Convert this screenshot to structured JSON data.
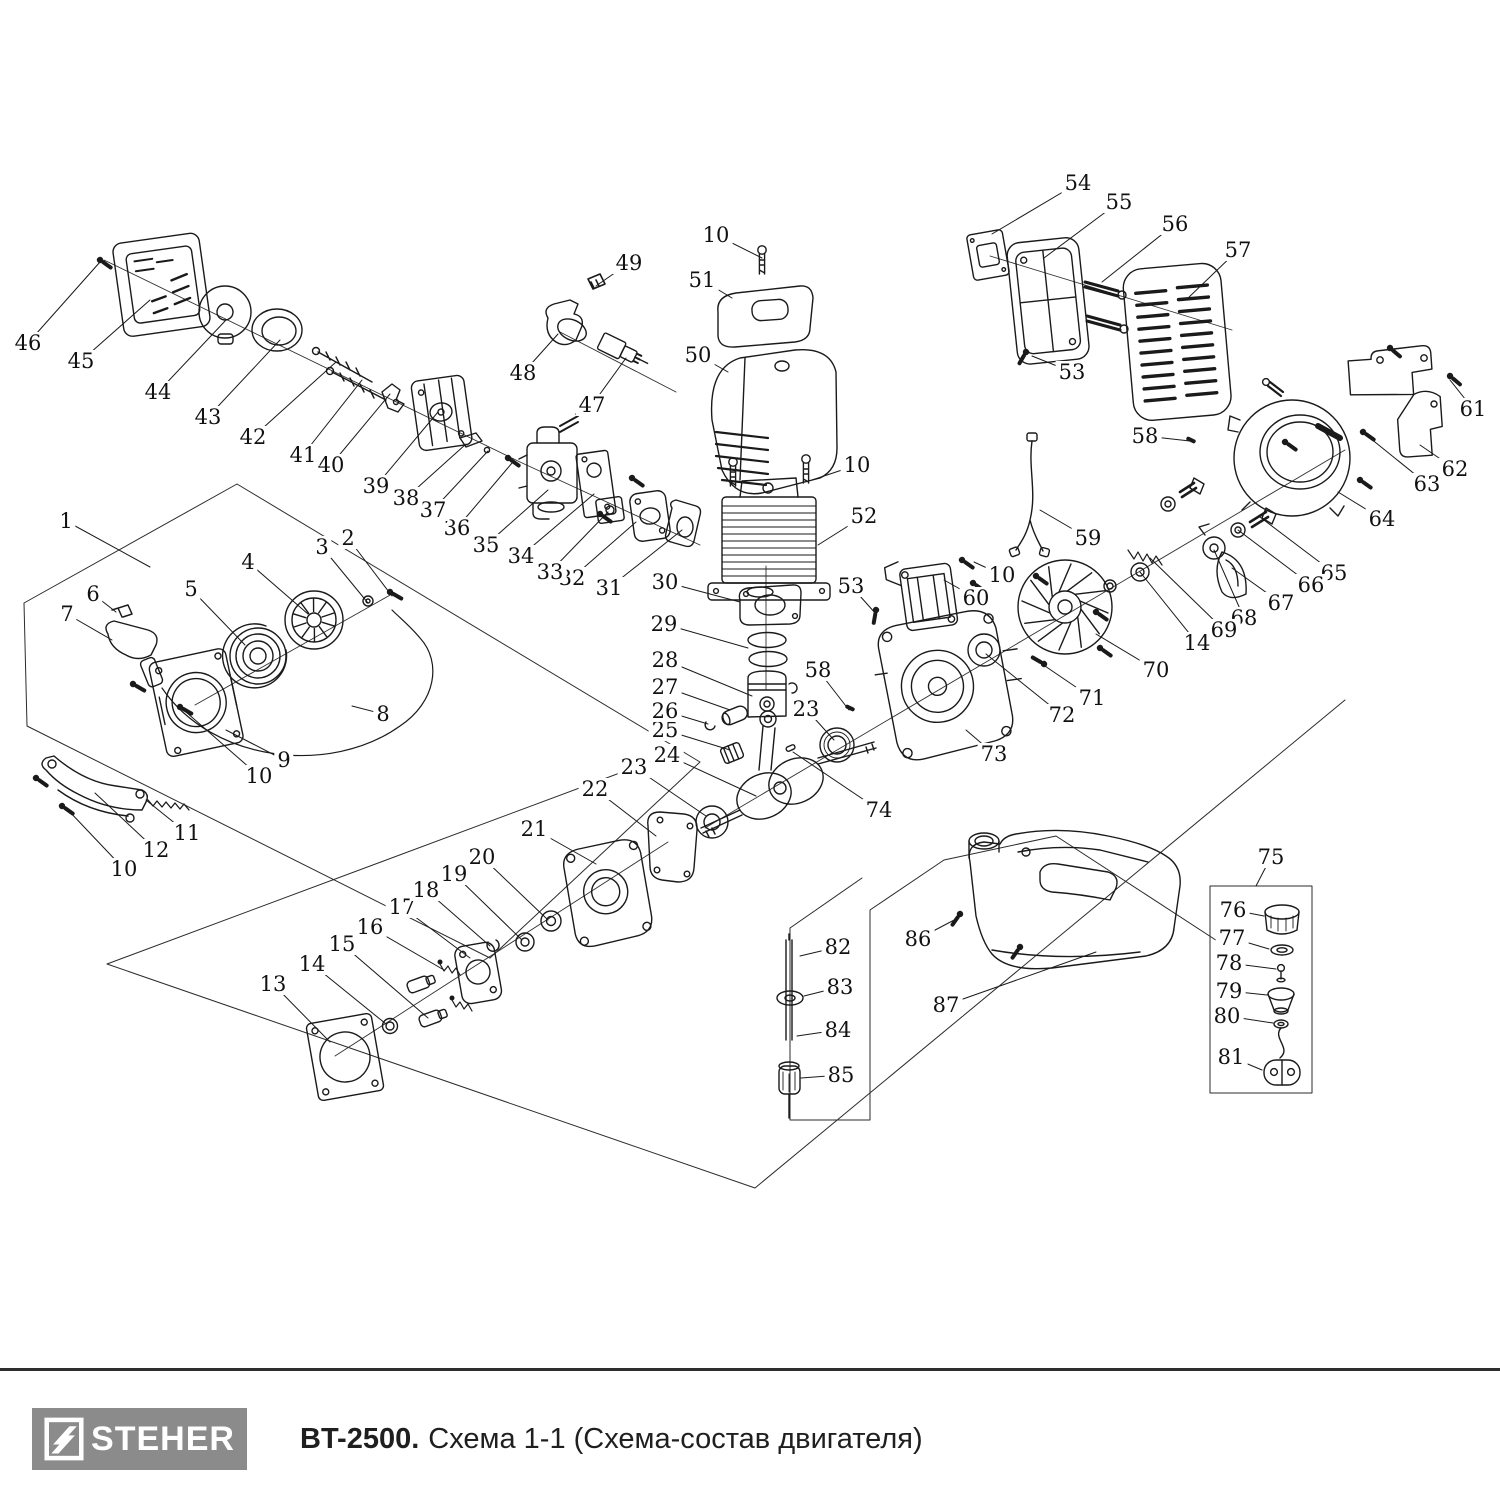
{
  "page": {
    "background": "#ffffff",
    "line_color": "#1a1a1a"
  },
  "footer": {
    "brand": "STEHER",
    "brand_bg": "#8b8b8b",
    "title_bold": "BT-2500.",
    "title_rest": "Схема 1-1 (Схема-состав двигателя)"
  },
  "diagram": {
    "kind": "exploded-parts-diagram",
    "callouts": [
      {
        "n": "1",
        "x": 66,
        "y": 521,
        "tx": 150,
        "ty": 567
      },
      {
        "n": "2",
        "x": 348,
        "y": 538,
        "tx": 392,
        "ty": 596
      },
      {
        "n": "3",
        "x": 322,
        "y": 547,
        "tx": 368,
        "ty": 603
      },
      {
        "n": "4",
        "x": 248,
        "y": 562,
        "tx": 308,
        "ty": 614
      },
      {
        "n": "5",
        "x": 191,
        "y": 589,
        "tx": 245,
        "ty": 645
      },
      {
        "n": "6",
        "x": 93,
        "y": 594,
        "tx": 116,
        "ty": 612
      },
      {
        "n": "7",
        "x": 67,
        "y": 614,
        "tx": 112,
        "ty": 640
      },
      {
        "n": "8",
        "x": 383,
        "y": 714,
        "tx": 352,
        "ty": 706
      },
      {
        "n": "9",
        "x": 284,
        "y": 760,
        "tx": 226,
        "ty": 730
      },
      {
        "n": "10",
        "x": 716,
        "y": 235,
        "tx": 762,
        "ty": 258
      },
      {
        "n": "10",
        "x": 857,
        "y": 465,
        "tx": 812,
        "ty": 480
      },
      {
        "n": "10",
        "x": 1002,
        "y": 575,
        "tx": 974,
        "ty": 562
      },
      {
        "n": "10",
        "x": 259,
        "y": 776,
        "tx": 186,
        "ty": 712
      },
      {
        "n": "10",
        "x": 124,
        "y": 869,
        "tx": 68,
        "ty": 810
      },
      {
        "n": "11",
        "x": 187,
        "y": 833,
        "tx": 146,
        "ty": 800
      },
      {
        "n": "12",
        "x": 156,
        "y": 850,
        "tx": 95,
        "ty": 793
      },
      {
        "n": "13",
        "x": 273,
        "y": 984,
        "tx": 330,
        "ty": 1042
      },
      {
        "n": "14",
        "x": 312,
        "y": 964,
        "tx": 386,
        "ty": 1024
      },
      {
        "n": "14",
        "x": 1197,
        "y": 643,
        "tx": 1140,
        "ty": 572
      },
      {
        "n": "15",
        "x": 342,
        "y": 944,
        "tx": 428,
        "ty": 1018
      },
      {
        "n": "16",
        "x": 370,
        "y": 927,
        "tx": 444,
        "ty": 970
      },
      {
        "n": "17",
        "x": 402,
        "y": 907,
        "tx": 470,
        "ty": 958
      },
      {
        "n": "18",
        "x": 426,
        "y": 890,
        "tx": 490,
        "ty": 946
      },
      {
        "n": "19",
        "x": 454,
        "y": 874,
        "tx": 522,
        "ty": 940
      },
      {
        "n": "20",
        "x": 482,
        "y": 857,
        "tx": 548,
        "ty": 920
      },
      {
        "n": "21",
        "x": 534,
        "y": 829,
        "tx": 596,
        "ty": 864
      },
      {
        "n": "22",
        "x": 595,
        "y": 789,
        "tx": 656,
        "ty": 836
      },
      {
        "n": "23",
        "x": 634,
        "y": 767,
        "tx": 706,
        "ty": 816
      },
      {
        "n": "23",
        "x": 806,
        "y": 709,
        "tx": 834,
        "ty": 740
      },
      {
        "n": "24",
        "x": 667,
        "y": 755,
        "tx": 756,
        "ty": 796
      },
      {
        "n": "25",
        "x": 665,
        "y": 730,
        "tx": 730,
        "ty": 750
      },
      {
        "n": "26",
        "x": 665,
        "y": 711,
        "tx": 708,
        "ty": 724
      },
      {
        "n": "27",
        "x": 665,
        "y": 687,
        "tx": 730,
        "ty": 710
      },
      {
        "n": "28",
        "x": 665,
        "y": 660,
        "tx": 752,
        "ty": 696
      },
      {
        "n": "29",
        "x": 664,
        "y": 624,
        "tx": 748,
        "ty": 648
      },
      {
        "n": "30",
        "x": 665,
        "y": 582,
        "tx": 740,
        "ty": 602
      },
      {
        "n": "31",
        "x": 609,
        "y": 588,
        "tx": 682,
        "ty": 530
      },
      {
        "n": "32",
        "x": 572,
        "y": 578,
        "tx": 636,
        "ty": 522
      },
      {
        "n": "33",
        "x": 550,
        "y": 572,
        "tx": 608,
        "ty": 512
      },
      {
        "n": "34",
        "x": 521,
        "y": 556,
        "tx": 594,
        "ty": 494
      },
      {
        "n": "35",
        "x": 486,
        "y": 545,
        "tx": 548,
        "ty": 490
      },
      {
        "n": "36",
        "x": 457,
        "y": 528,
        "tx": 512,
        "ty": 463
      },
      {
        "n": "37",
        "x": 433,
        "y": 510,
        "tx": 488,
        "ty": 451
      },
      {
        "n": "38",
        "x": 406,
        "y": 498,
        "tx": 466,
        "ty": 444
      },
      {
        "n": "39",
        "x": 376,
        "y": 486,
        "tx": 438,
        "ty": 412
      },
      {
        "n": "40",
        "x": 331,
        "y": 465,
        "tx": 390,
        "ty": 394
      },
      {
        "n": "41",
        "x": 303,
        "y": 455,
        "tx": 362,
        "ty": 380
      },
      {
        "n": "42",
        "x": 253,
        "y": 437,
        "tx": 336,
        "ty": 362
      },
      {
        "n": "43",
        "x": 208,
        "y": 417,
        "tx": 280,
        "ty": 340
      },
      {
        "n": "44",
        "x": 158,
        "y": 392,
        "tx": 226,
        "ty": 320
      },
      {
        "n": "45",
        "x": 81,
        "y": 361,
        "tx": 150,
        "ty": 300
      },
      {
        "n": "46",
        "x": 28,
        "y": 343,
        "tx": 100,
        "ty": 262
      },
      {
        "n": "47",
        "x": 592,
        "y": 405,
        "tx": 626,
        "ty": 358
      },
      {
        "n": "48",
        "x": 523,
        "y": 373,
        "tx": 558,
        "ty": 334
      },
      {
        "n": "49",
        "x": 629,
        "y": 263,
        "tx": 596,
        "ty": 286
      },
      {
        "n": "50",
        "x": 698,
        "y": 355,
        "tx": 728,
        "ty": 372
      },
      {
        "n": "51",
        "x": 702,
        "y": 280,
        "tx": 732,
        "ty": 298
      },
      {
        "n": "52",
        "x": 864,
        "y": 516,
        "tx": 818,
        "ty": 545
      },
      {
        "n": "53",
        "x": 1072,
        "y": 372,
        "tx": 1032,
        "ty": 356
      },
      {
        "n": "53",
        "x": 851,
        "y": 586,
        "tx": 876,
        "ty": 614
      },
      {
        "n": "54",
        "x": 1078,
        "y": 183,
        "tx": 992,
        "ty": 234
      },
      {
        "n": "55",
        "x": 1119,
        "y": 202,
        "tx": 1044,
        "ty": 258
      },
      {
        "n": "56",
        "x": 1175,
        "y": 224,
        "tx": 1102,
        "ty": 282
      },
      {
        "n": "57",
        "x": 1238,
        "y": 250,
        "tx": 1186,
        "ty": 300
      },
      {
        "n": "58",
        "x": 1145,
        "y": 436,
        "tx": 1190,
        "ty": 441
      },
      {
        "n": "58",
        "x": 818,
        "y": 670,
        "tx": 849,
        "ty": 710
      },
      {
        "n": "59",
        "x": 1088,
        "y": 538,
        "tx": 1040,
        "ty": 510
      },
      {
        "n": "60",
        "x": 976,
        "y": 598,
        "tx": 944,
        "ty": 580
      },
      {
        "n": "61",
        "x": 1473,
        "y": 409,
        "tx": 1450,
        "ty": 380
      },
      {
        "n": "62",
        "x": 1455,
        "y": 469,
        "tx": 1420,
        "ty": 445
      },
      {
        "n": "63",
        "x": 1427,
        "y": 484,
        "tx": 1365,
        "ty": 434
      },
      {
        "n": "64",
        "x": 1382,
        "y": 519,
        "tx": 1338,
        "ty": 492
      },
      {
        "n": "65",
        "x": 1334,
        "y": 573,
        "tx": 1260,
        "ty": 517
      },
      {
        "n": "66",
        "x": 1311,
        "y": 585,
        "tx": 1238,
        "ty": 530
      },
      {
        "n": "67",
        "x": 1281,
        "y": 603,
        "tx": 1232,
        "ty": 568
      },
      {
        "n": "68",
        "x": 1244,
        "y": 618,
        "tx": 1214,
        "ty": 550
      },
      {
        "n": "69",
        "x": 1224,
        "y": 630,
        "tx": 1150,
        "ty": 558
      },
      {
        "n": "70",
        "x": 1156,
        "y": 670,
        "tx": 1096,
        "ty": 634
      },
      {
        "n": "71",
        "x": 1092,
        "y": 698,
        "tx": 1042,
        "ty": 664
      },
      {
        "n": "72",
        "x": 1062,
        "y": 715,
        "tx": 986,
        "ty": 654
      },
      {
        "n": "73",
        "x": 994,
        "y": 754,
        "tx": 966,
        "ty": 730
      },
      {
        "n": "74",
        "x": 879,
        "y": 810,
        "tx": 793,
        "ty": 752
      },
      {
        "n": "75",
        "x": 1271,
        "y": 857,
        "tx": 1256,
        "ty": 886
      },
      {
        "n": "76",
        "x": 1233,
        "y": 910,
        "tx": 1264,
        "ty": 916
      },
      {
        "n": "77",
        "x": 1232,
        "y": 938,
        "tx": 1269,
        "ty": 949
      },
      {
        "n": "78",
        "x": 1229,
        "y": 963,
        "tx": 1276,
        "ty": 969
      },
      {
        "n": "79",
        "x": 1229,
        "y": 991,
        "tx": 1267,
        "ty": 995
      },
      {
        "n": "80",
        "x": 1227,
        "y": 1016,
        "tx": 1273,
        "ty": 1023
      },
      {
        "n": "81",
        "x": 1231,
        "y": 1057,
        "tx": 1262,
        "ty": 1070
      },
      {
        "n": "82",
        "x": 838,
        "y": 947,
        "tx": 800,
        "ty": 956
      },
      {
        "n": "83",
        "x": 840,
        "y": 987,
        "tx": 804,
        "ty": 996
      },
      {
        "n": "84",
        "x": 838,
        "y": 1030,
        "tx": 797,
        "ty": 1036
      },
      {
        "n": "85",
        "x": 841,
        "y": 1075,
        "tx": 801,
        "ty": 1078
      },
      {
        "n": "86",
        "x": 918,
        "y": 939,
        "tx": 958,
        "ty": 918
      },
      {
        "n": "87",
        "x": 946,
        "y": 1005,
        "tx": 1096,
        "ty": 952
      }
    ]
  }
}
